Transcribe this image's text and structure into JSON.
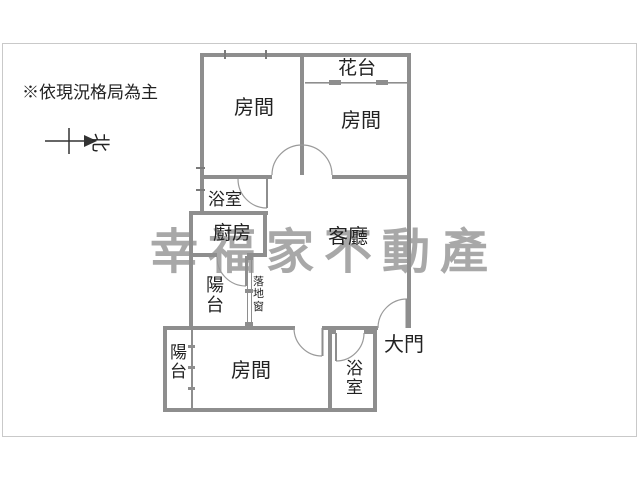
{
  "colors": {
    "wall": "#8e8e8e",
    "frame": "#c9c9c9",
    "door": "#9a9a9a",
    "text": "#222222",
    "watermark": "#a8a8a8"
  },
  "disclaimer": "※依現況格局為主",
  "compass": {
    "north_label": "北"
  },
  "watermark": {
    "text": "幸福家不動產"
  },
  "labels": {
    "bedroom_top_left": "房間",
    "bedroom_top_right": "房間",
    "flower_terrace": "花台",
    "bathroom_upper": "浴室",
    "kitchen": "廚房",
    "living_room": "客廳",
    "balcony_upper": "陽台",
    "floor_to_ceiling_window": "落地窗",
    "balcony_lower": "陽台",
    "bedroom_lower": "房間",
    "bathroom_lower": "浴室",
    "main_entrance": "大門"
  }
}
